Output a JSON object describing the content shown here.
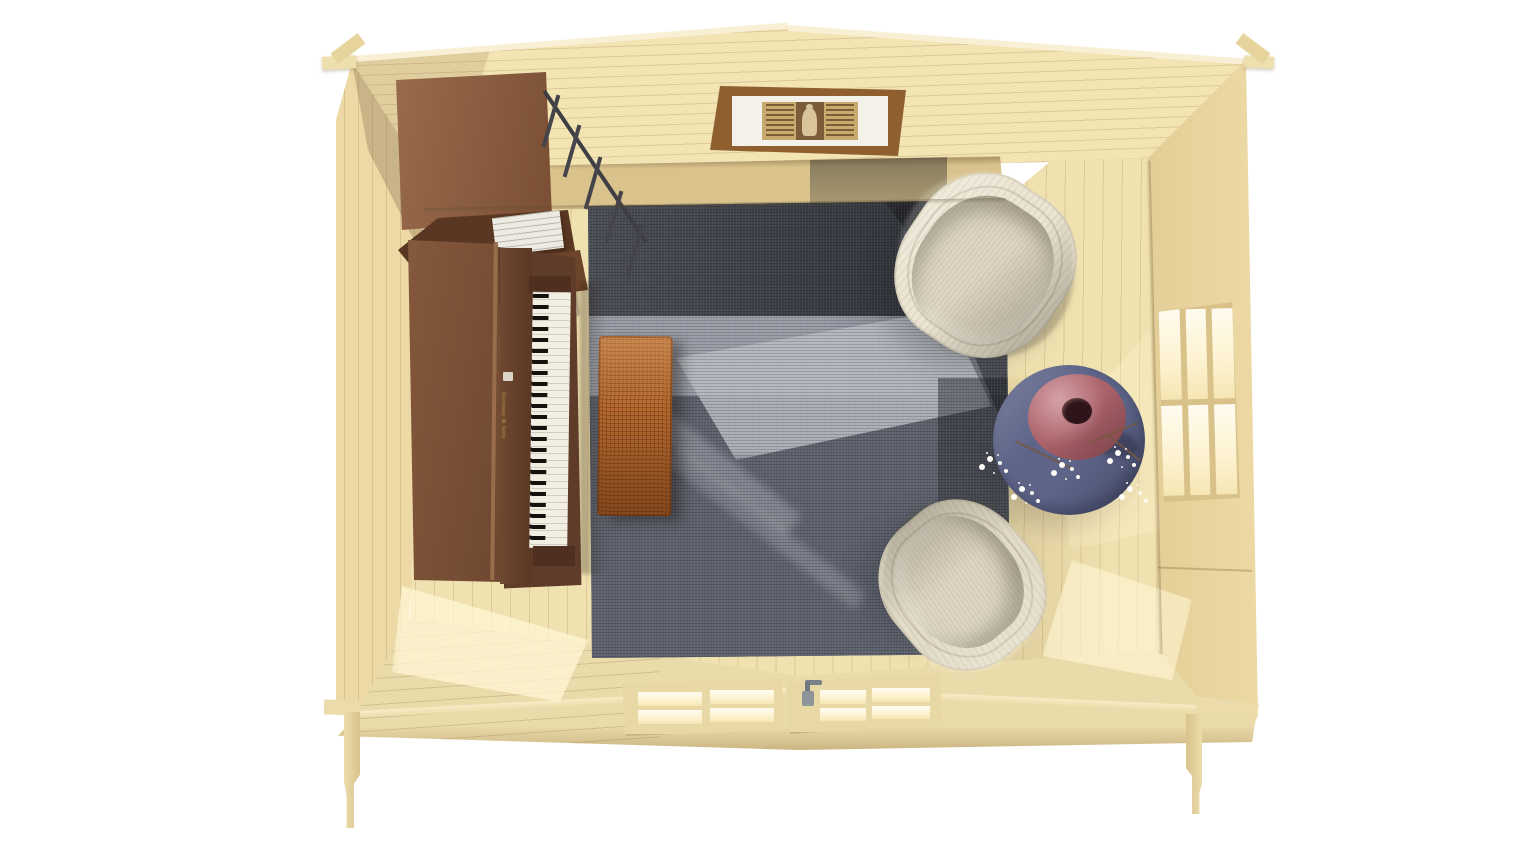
{
  "meta": {
    "title": "Top-down 3D render of a log cabin music room",
    "render_type": "3d-architectural-render"
  },
  "scene": {
    "background_color": "#ffffff",
    "description": "Bird's-eye view into a small pine cabin: upright piano and walnut shelving on the left, grey woven rug with rattan coffee table, two cream wicker tub chairs, round blue side table with mauve vase and white blossoms, six-pane window on the right wall, glazed double doors on the front wall, interlocking corner joints.",
    "palette": {
      "pine_light": "#f3e4b4",
      "pine": "#ecd9a6",
      "pine_floor": "#f0e1b0",
      "pine_shadow": "#d9c28c",
      "walnut": "#7e5539",
      "walnut_dark": "#5a3722",
      "rattan": "#b5692f",
      "rug_dark": "#2f3137",
      "rug_mid": "#666b76",
      "rug_light": "#b9bcc4",
      "chair_cream": "#ece5d4",
      "chair_taupe": "#e3dcc9",
      "table_blue": "#5e6589",
      "vase_mauve": "#ab626a",
      "blossom_white": "#fdfcf8",
      "key_white": "#f2eee2",
      "key_black": "#15120d",
      "metal_dark": "#45444a",
      "window_glow": "#fff3d2",
      "gold": "#c9a44a"
    },
    "objects": {
      "cabin": {
        "label": "Log cabin shell seen from directly above"
      },
      "gable_wall": {
        "label": "Back gable wall with horizontal boards"
      },
      "back_wall": {
        "label": "Lower back wall, vertical boards"
      },
      "left_wall": {
        "label": "Left wall"
      },
      "right_wall": {
        "label": "Right wall"
      },
      "front_wall": {
        "label": "Front wall with glazed double doors"
      },
      "floor": {
        "label": "Pine plank floor"
      },
      "rug": {
        "label": "Grey woven area rug with tonal bands"
      },
      "piano": {
        "label": "Walnut upright piano",
        "brand_text": "Steinway & Sons"
      },
      "keyboard": {
        "label": "Piano keyboard, keys facing the rug"
      },
      "bookshelf": {
        "label": "Walnut shelving unit with metal frame"
      },
      "books": {
        "label": "White books lying on shelf"
      },
      "railing": {
        "label": "Dark metal shelf posts"
      },
      "bench": {
        "label": "Rattan coffee table on rug"
      },
      "chair_top": {
        "label": "Cream wicker tub chair (upper)"
      },
      "chair_bottom": {
        "label": "Beige wicker tub chair (lower)"
      },
      "side_table": {
        "label": "Round slate-blue side table"
      },
      "vase": {
        "label": "Mauve donut-shaped vase"
      },
      "blossoms": {
        "label": "White blossom branches"
      },
      "picture": {
        "label": "Framed vintage print on gable wall"
      },
      "window": {
        "label": "Six-pane window, right wall"
      },
      "doors": {
        "label": "Glazed double doors, front wall"
      },
      "door_handle": {
        "label": "Grey door handle"
      },
      "sunlight": {
        "label": "Sunlight patches on floor"
      },
      "corner_joints": {
        "label": "Interlocking log corner joints"
      }
    }
  }
}
